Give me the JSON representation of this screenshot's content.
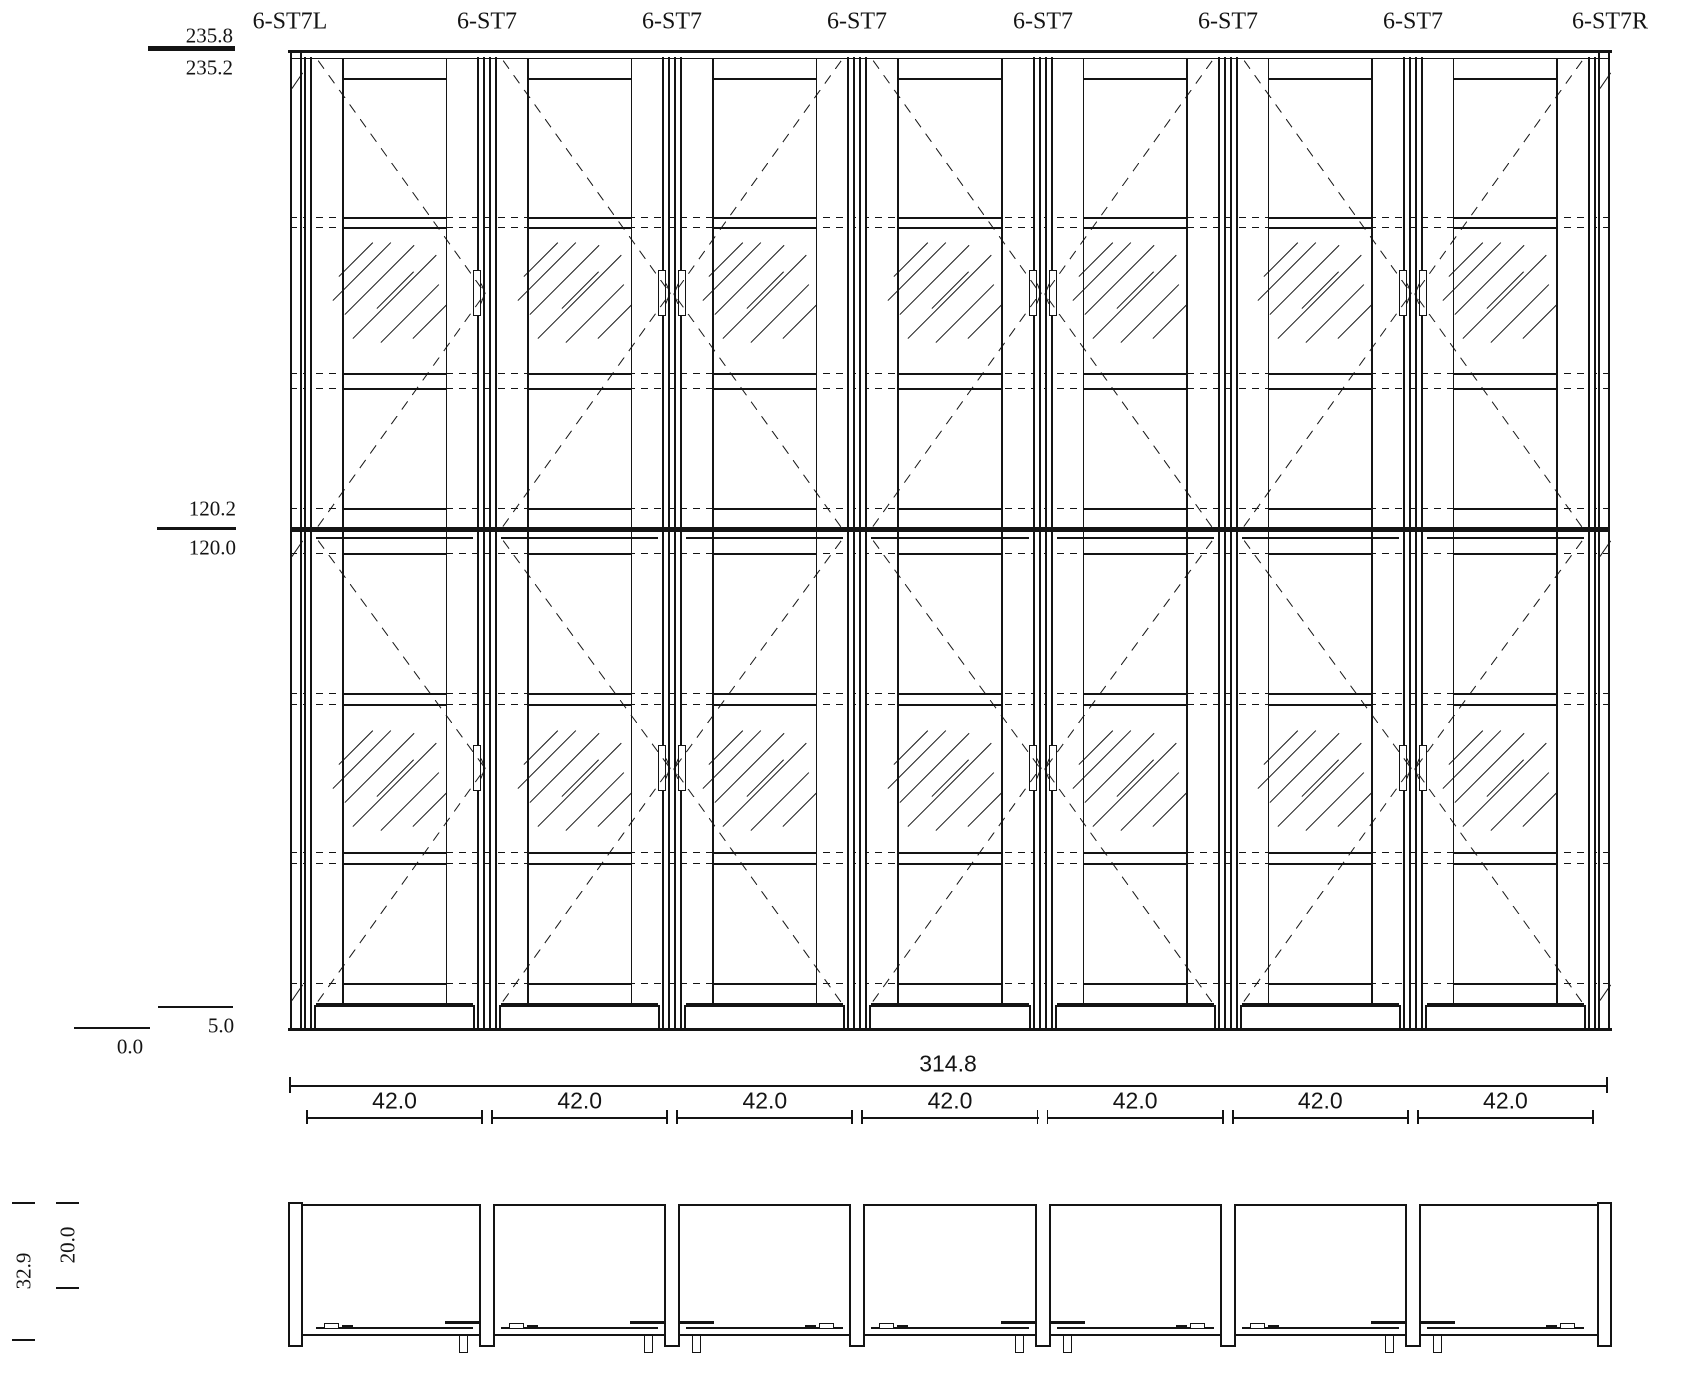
{
  "drawing": {
    "unit_labels": [
      "6-ST7L",
      "6-ST7",
      "6-ST7",
      "6-ST7",
      "6-ST7",
      "6-ST7",
      "6-ST7",
      "6-ST7R"
    ],
    "bays": [
      {
        "handle": "right"
      },
      {
        "handle": "right"
      },
      {
        "handle": "left"
      },
      {
        "handle": "right"
      },
      {
        "handle": "left"
      },
      {
        "handle": "right"
      },
      {
        "handle": "left"
      }
    ],
    "levels": {
      "top": {
        "above": "235.8",
        "below": "235.2"
      },
      "middle": {
        "above": "120.2",
        "below": "120.0"
      },
      "plinth": "5.0",
      "floor": "0.0"
    },
    "dimensions": {
      "overall_width": "314.8",
      "bay_widths": [
        "42.0",
        "42.0",
        "42.0",
        "42.0",
        "42.0",
        "42.0",
        "42.0"
      ],
      "overall_depth": "32.9",
      "body_depth": "20.0"
    }
  },
  "colors": {
    "line": "#141414",
    "background": "#ffffff"
  }
}
